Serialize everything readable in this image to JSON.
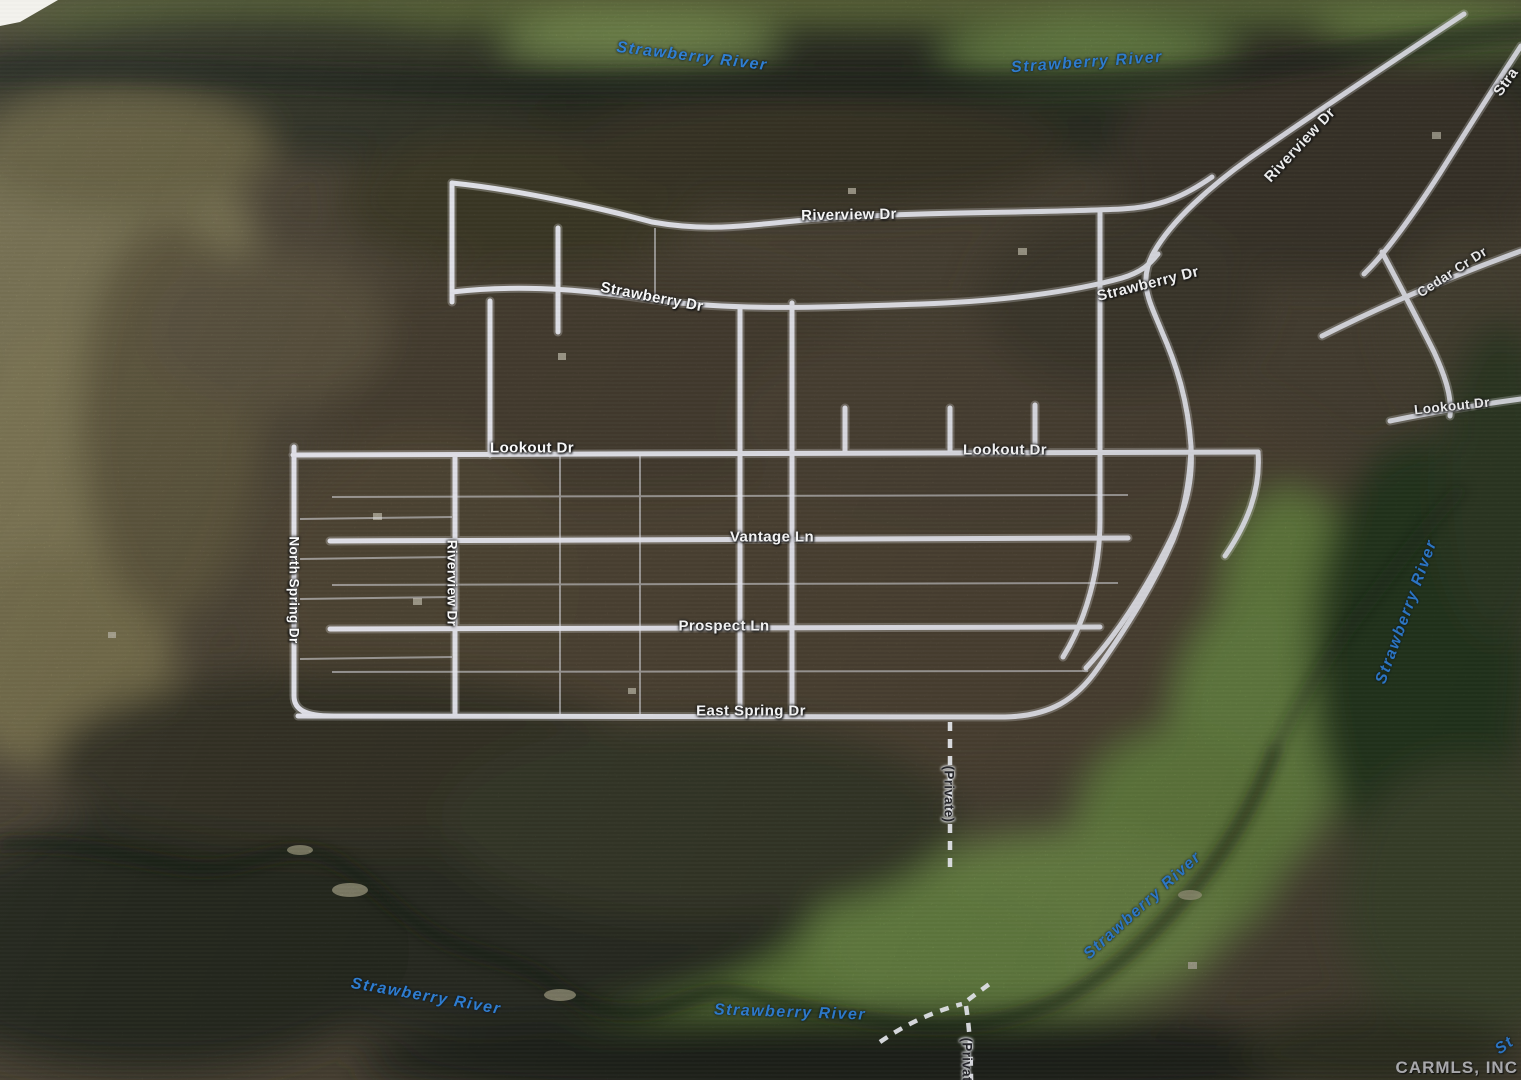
{
  "map": {
    "type": "aerial-satellite-with-road-overlay",
    "subject": "rural subdivision plat along a river",
    "colors": {
      "road_line": "#e8e9f1",
      "road_label": "#fdfdfd",
      "river_label": "#2e7fd6",
      "private_label": "#26262b",
      "field_green": "#82a155",
      "forest_dark": "#32352a"
    },
    "watermark": "CARMLS, INC"
  },
  "labels": [
    {
      "id": "river-top-left",
      "kind": "river",
      "text": "Strawberry River"
    },
    {
      "id": "river-top",
      "kind": "river",
      "text": "Strawberry River"
    },
    {
      "id": "riverview-dr-top",
      "kind": "road",
      "text": "Riverview Dr"
    },
    {
      "id": "riverview-dr-right-diagonal",
      "kind": "road",
      "text": "Riverview Dr"
    },
    {
      "id": "strawberry-partial-corner",
      "kind": "road",
      "text": "Stra"
    },
    {
      "id": "strawberry-dr-left",
      "kind": "road",
      "text": "Strawberry Dr"
    },
    {
      "id": "strawberry-dr-right",
      "kind": "road",
      "text": "Strawberry Dr"
    },
    {
      "id": "cedar-cr-dr",
      "kind": "road",
      "text": "Cedar Cr Dr"
    },
    {
      "id": "lookout-dr-far-right",
      "kind": "road",
      "text": "Lookout Dr"
    },
    {
      "id": "lookout-dr-left",
      "kind": "road",
      "text": "Lookout Dr"
    },
    {
      "id": "lookout-dr-center",
      "kind": "road",
      "text": "Lookout Dr"
    },
    {
      "id": "vantage-ln",
      "kind": "road",
      "text": "Vantage Ln"
    },
    {
      "id": "prospect-ln",
      "kind": "road",
      "text": "Prospect Ln"
    },
    {
      "id": "east-spring-dr",
      "kind": "road",
      "text": "East Spring Dr"
    },
    {
      "id": "north-spring-dr",
      "kind": "road",
      "text": "North Spring Dr"
    },
    {
      "id": "riverview-dr-vertical",
      "kind": "road",
      "text": "Riverview Dr"
    },
    {
      "id": "private-upper",
      "kind": "private",
      "text": "(Private)"
    },
    {
      "id": "river-right",
      "kind": "river",
      "text": "Strawberry River"
    },
    {
      "id": "river-bottom-right",
      "kind": "river",
      "text": "Strawberry River"
    },
    {
      "id": "river-bottom-left",
      "kind": "river",
      "text": "Strawberry River"
    },
    {
      "id": "river-bottom-center",
      "kind": "river",
      "text": "Strawberry River"
    },
    {
      "id": "private-bottom",
      "kind": "private",
      "text": "(Private)"
    },
    {
      "id": "river-partial-right-edge",
      "kind": "river",
      "text": "St"
    },
    {
      "id": "watermark",
      "kind": "watermark",
      "text": "CARMLS, INC"
    }
  ]
}
